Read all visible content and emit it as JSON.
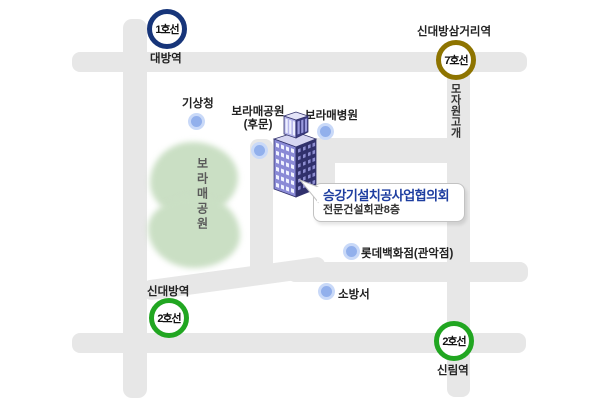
{
  "stations": [
    {
      "line_badge": "1호선",
      "station_name": "대방역",
      "line_color": "#17357a"
    },
    {
      "line_badge": "7호선",
      "station_name": "신대방삼거리역",
      "line_color": "#8e7400"
    },
    {
      "line_badge": "2호선",
      "station_name": "신대방역",
      "line_color": "#21a621"
    },
    {
      "line_badge": "2호선",
      "station_name": "신림역",
      "line_color": "#21a621"
    }
  ],
  "pois": [
    {
      "name": "기상청"
    },
    {
      "name": "보라매공원",
      "sub": "(후문)"
    },
    {
      "name": "보라매병원"
    },
    {
      "name": "롯데백화점(관악점)"
    },
    {
      "name": "소방서"
    }
  ],
  "areas": {
    "park_label": "보라매공원",
    "park_color": "#cadfc4"
  },
  "road_labels": {
    "mojawon": "모자원고개"
  },
  "callout": {
    "title": "승강기설치공사업협의회",
    "subtitle": "전문건설회관8층",
    "title_color": "#1e3ea0"
  },
  "colors": {
    "road": "#e7e7e7",
    "poi_dot": "#92b0ec",
    "poi_dot_ring": "#c9d9f8",
    "building_front": "#30306c",
    "building_side": "#8a8ad6"
  }
}
